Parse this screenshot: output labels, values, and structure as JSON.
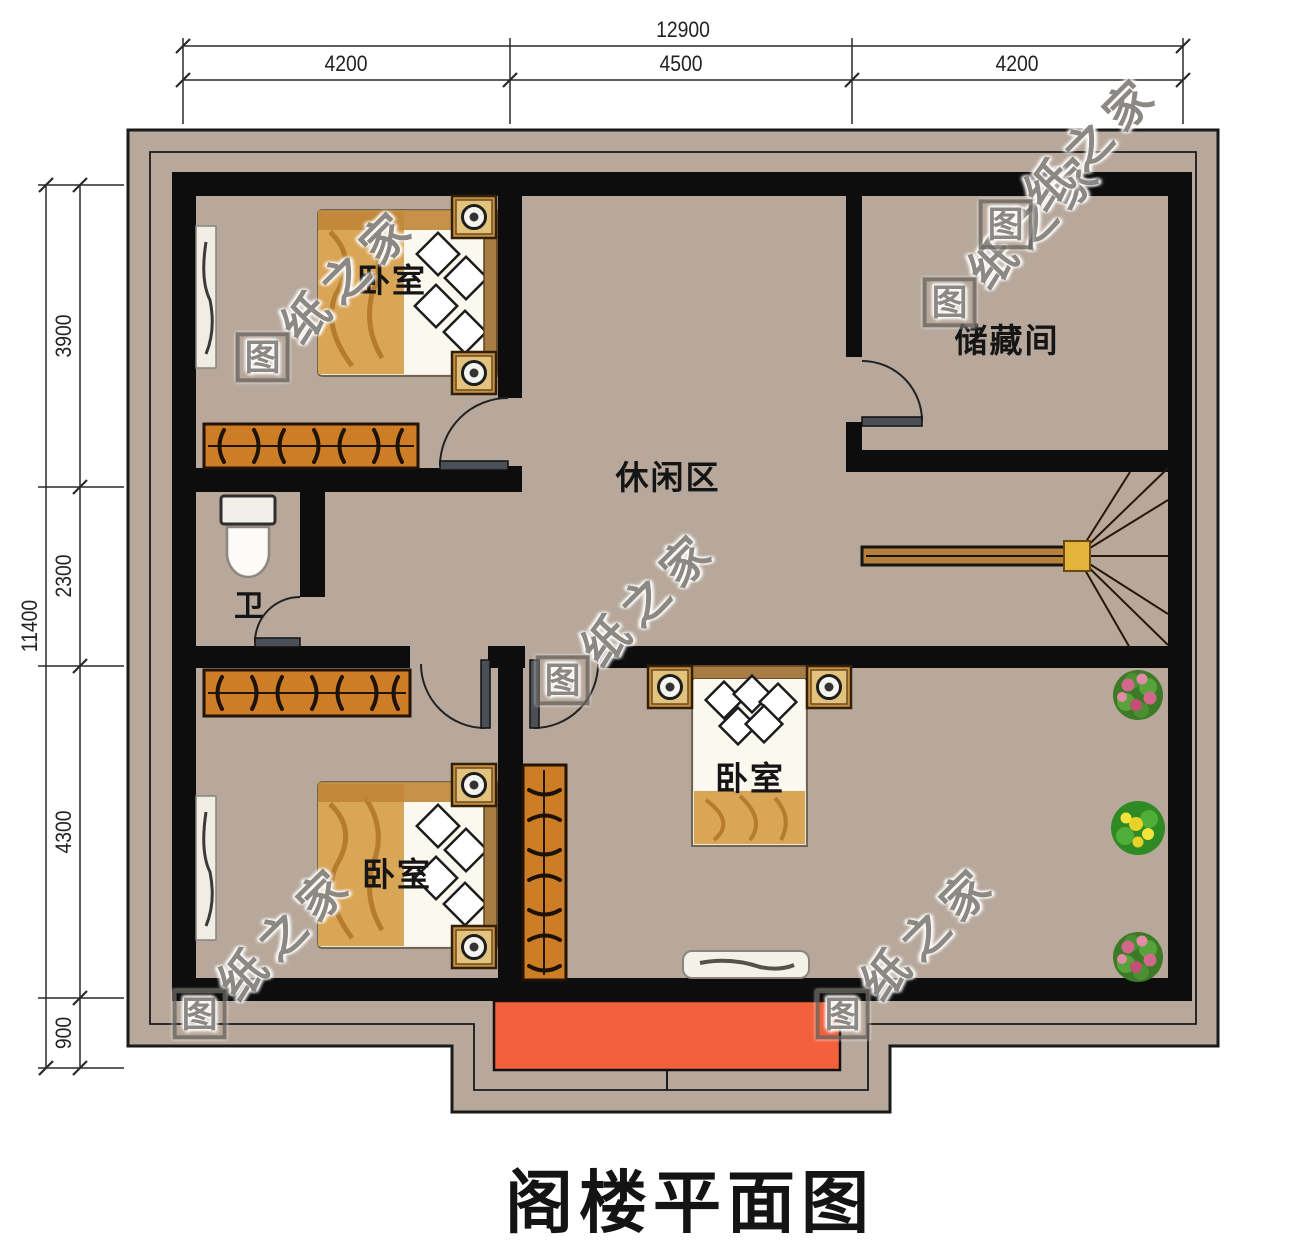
{
  "title": "阁楼平面图",
  "watermark": {
    "logo": "图",
    "rest": "纸之家"
  },
  "dimensions": {
    "top_total": "12900",
    "top_segments": [
      "4200",
      "4500",
      "4200"
    ],
    "left_total": "11400",
    "left_segments": [
      "3900",
      "2300",
      "4300",
      "900"
    ]
  },
  "rooms": {
    "bedroom_top_left": "卧室",
    "storage": "储藏间",
    "leisure": "休闲区",
    "bathroom": "卫",
    "bedroom_bottom_left": "卧室",
    "bedroom_bottom_right": "卧室"
  },
  "colors": {
    "roof_band": "#b7a89b",
    "wall": "#0d0d0d",
    "balcony": "#f2603c",
    "checker_blue": "#8fb5bf",
    "checker_cream": "#f2eeda",
    "wood_floor": "#c2a172",
    "leisure_tile": "#f5e8d8",
    "stair_wood": "#d79138",
    "wardrobe": "#cd7d26"
  }
}
